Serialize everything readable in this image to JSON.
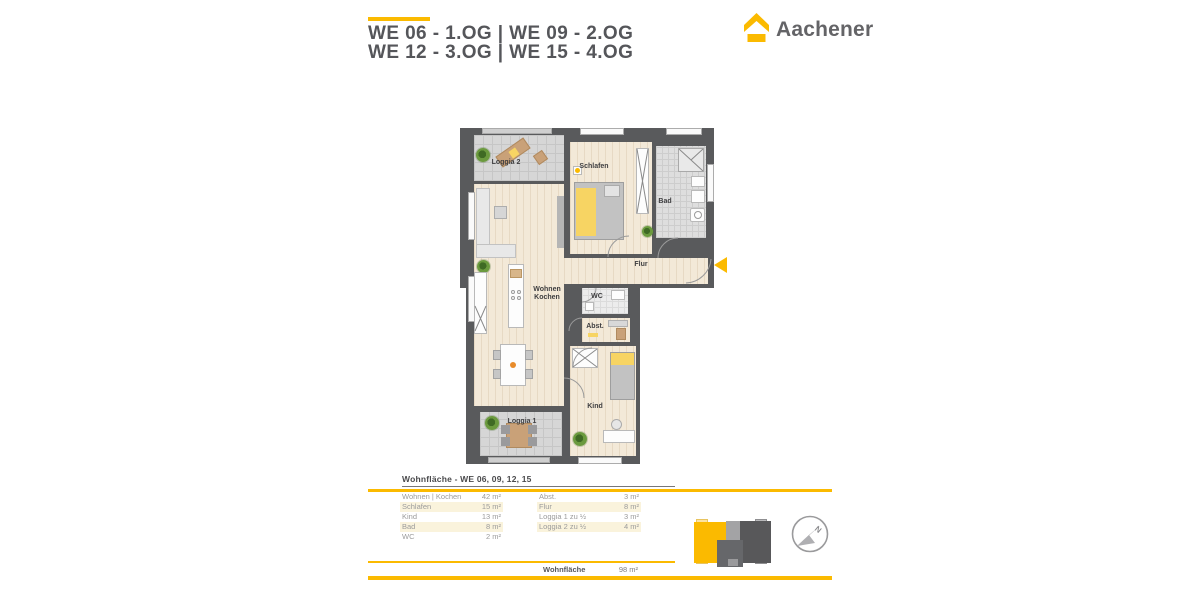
{
  "colors": {
    "accent": "#FBBA00",
    "wall": "#595A5C",
    "wood_floor": "#F3E9D8",
    "tile_floor": "#D6D6D6",
    "highlight_yellow": "#F7D463",
    "title_gray": "#55565A",
    "table_shade": "#FAF3DC"
  },
  "header": {
    "title_line1": "WE 06 - 1.OG | WE 09 - 2.OG",
    "title_line2": "WE 12 - 3.OG | WE 15 - 4.OG"
  },
  "logo": {
    "text": "Aachener"
  },
  "floorplan": {
    "rooms": {
      "loggia2": "Loggia 2",
      "schlafen": "Schlafen",
      "bad": "Bad",
      "flur": "Flur",
      "wohnen_line1": "Wohnen",
      "wohnen_line2": "Kochen",
      "wc": "WC",
      "abst": "Abst.",
      "kind": "Kind",
      "loggia1": "Loggia 1"
    }
  },
  "area_table": {
    "title": "Wohnfläche - WE 06, 09, 12, 15",
    "left_rows": [
      {
        "label": "Wohnen | Kochen",
        "value": "42 m²"
      },
      {
        "label": "Schlafen",
        "value": "15 m²"
      },
      {
        "label": "Kind",
        "value": "13 m²"
      },
      {
        "label": "Bad",
        "value": "8 m²"
      },
      {
        "label": "WC",
        "value": "2 m²"
      }
    ],
    "right_rows": [
      {
        "label": "Abst.",
        "value": "3 m²"
      },
      {
        "label": "Flur",
        "value": "8 m²"
      },
      {
        "label": "Loggia 1 zu ½",
        "value": "3 m²"
      },
      {
        "label": "Loggia 2 zu ½",
        "value": "4 m²"
      }
    ],
    "total_label": "Wohnfläche",
    "total_value": "98 m²"
  }
}
